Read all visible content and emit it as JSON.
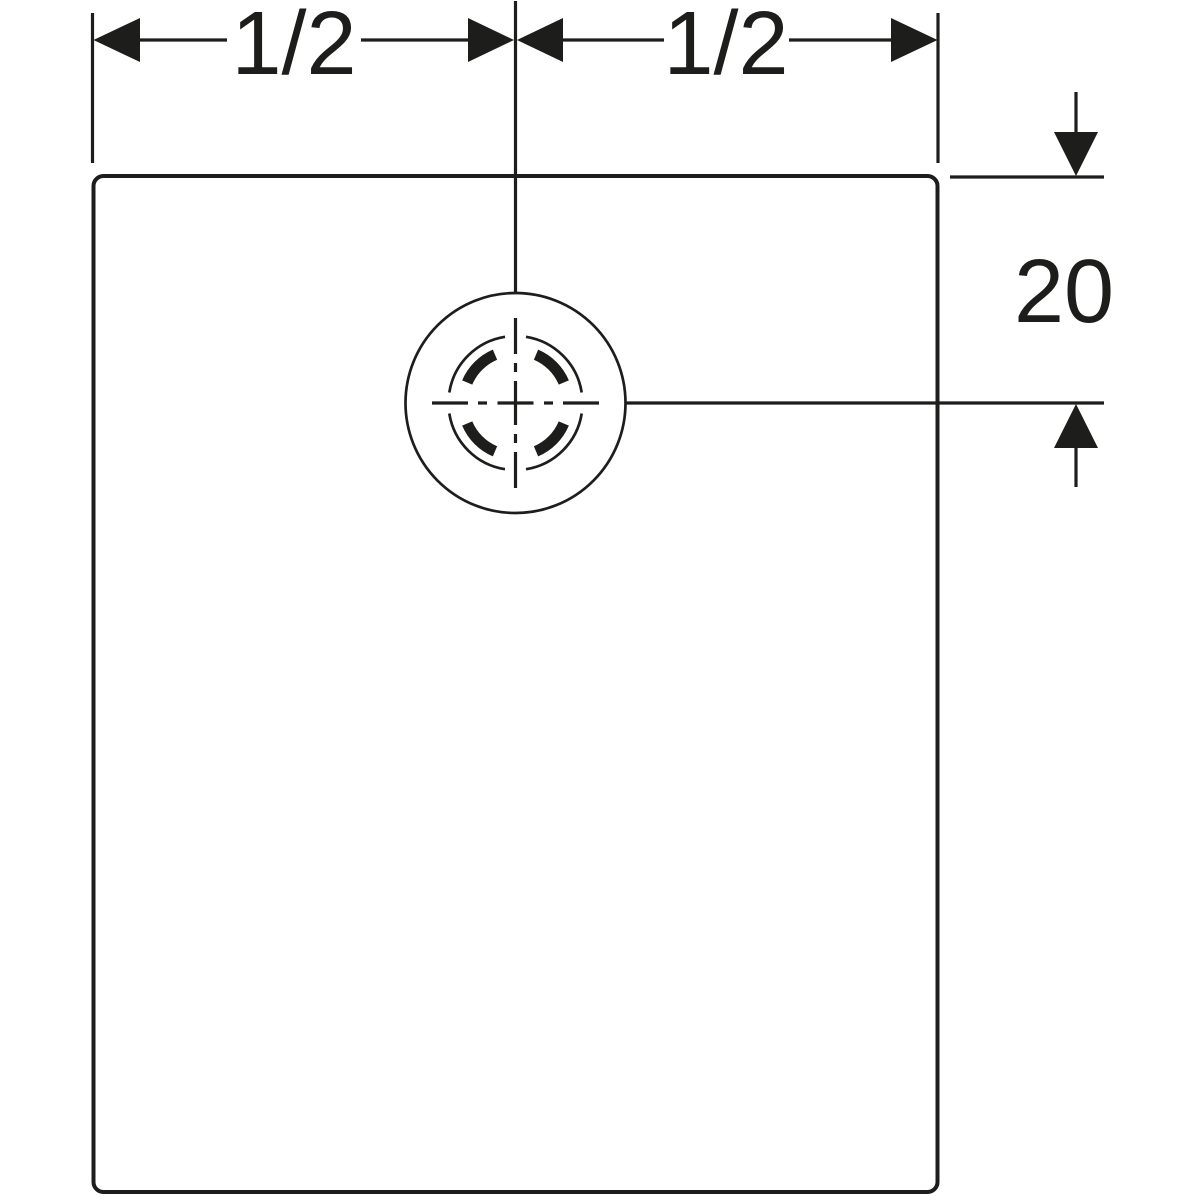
{
  "drawing": {
    "background_color": "#ffffff",
    "line_color": "#1d1d1b",
    "dimensions": {
      "top_left_half": {
        "label": "1/2"
      },
      "top_right_half": {
        "label": "1/2"
      },
      "drain_offset_from_top": {
        "label": "20"
      }
    }
  }
}
